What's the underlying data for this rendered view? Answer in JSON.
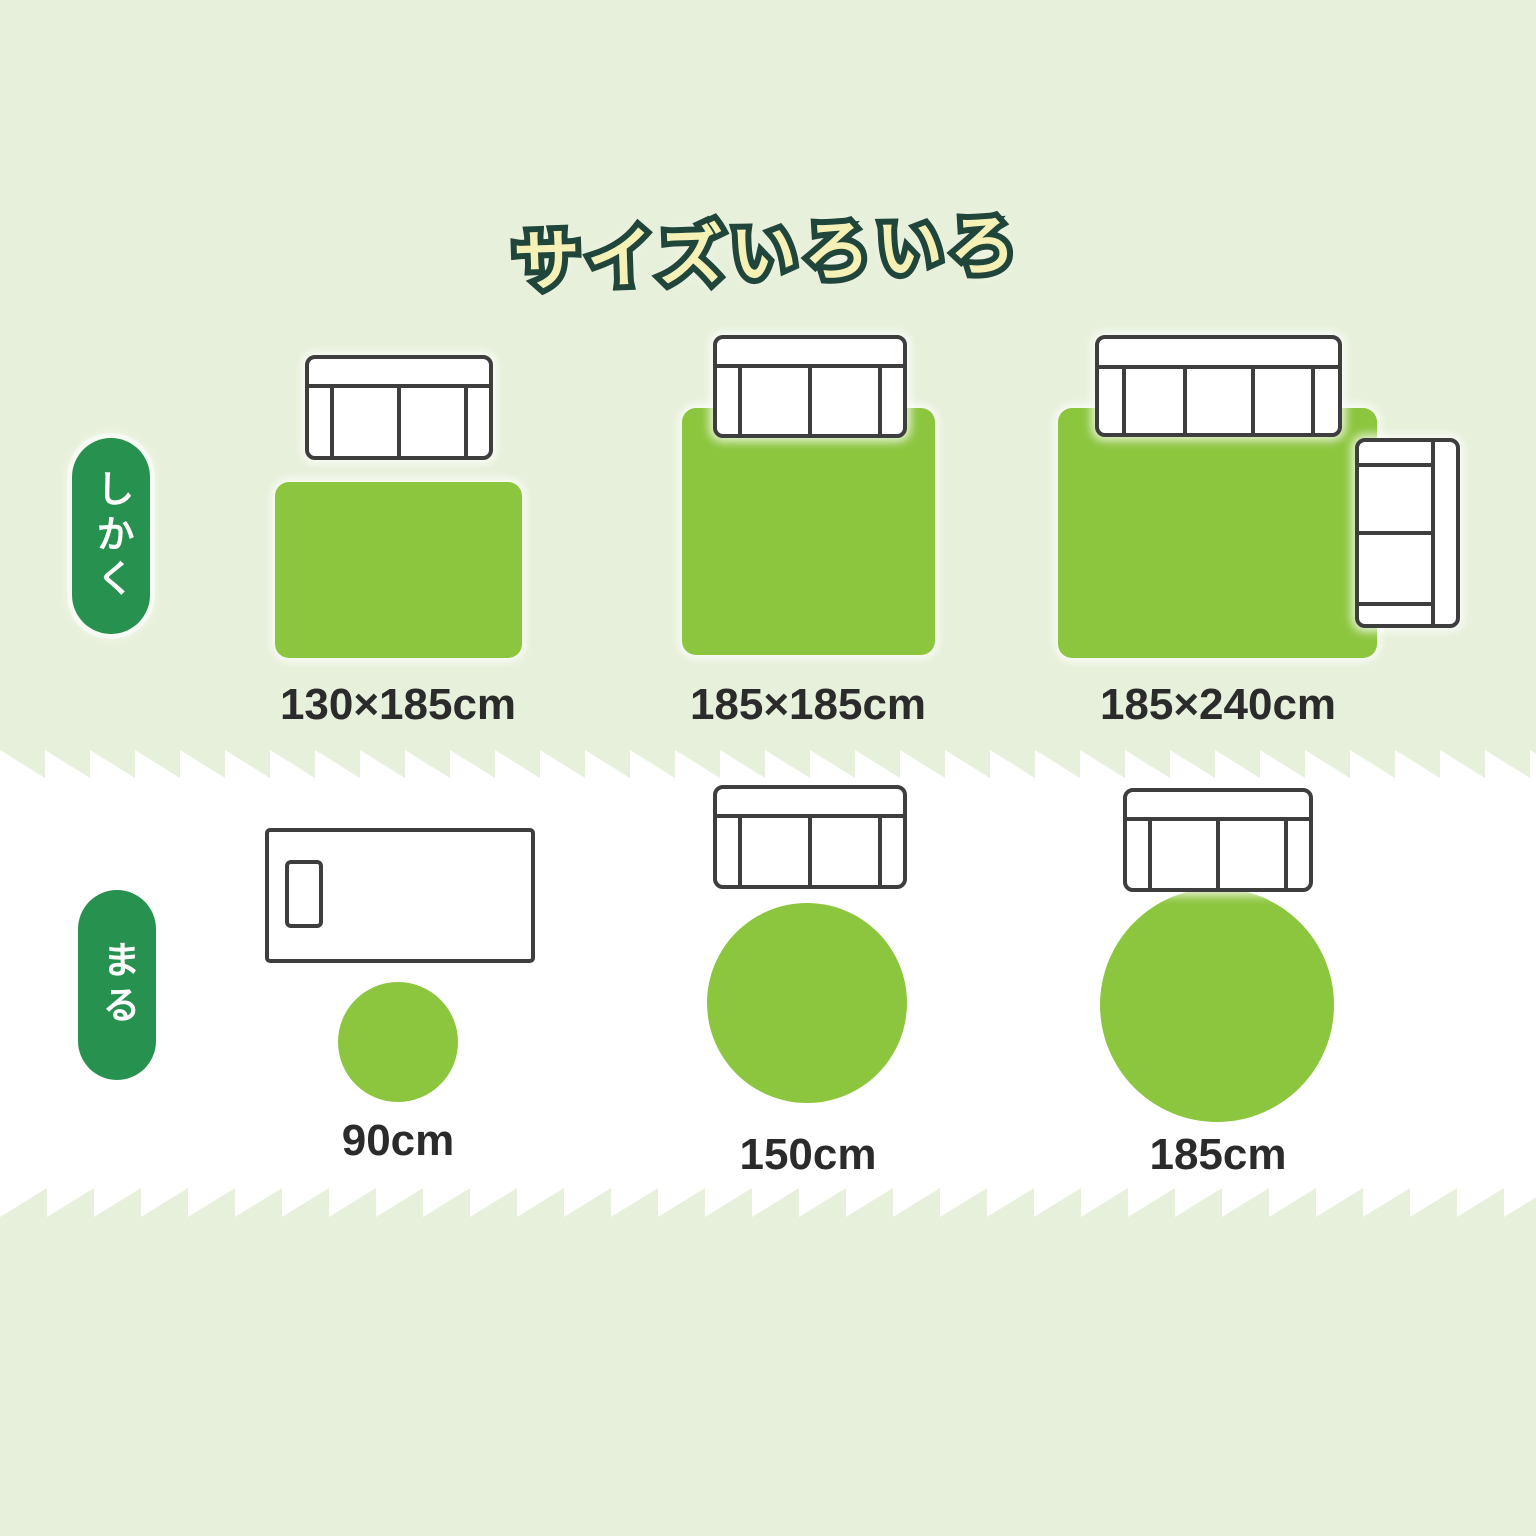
{
  "title": "サイズいろいろ",
  "sections": {
    "rect": {
      "badge": "しかく",
      "items": [
        {
          "shape": "rectangle",
          "label": "130×185cm",
          "furniture_icons": [
            "sofa-2seat-top-view-icon"
          ]
        },
        {
          "shape": "rectangle",
          "label": "185×185cm",
          "furniture_icons": [
            "sofa-2seat-top-view-icon"
          ]
        },
        {
          "shape": "rectangle",
          "label": "185×240cm",
          "furniture_icons": [
            "sofa-3seat-top-view-icon",
            "sofa-2seat-side-top-view-icon"
          ]
        }
      ]
    },
    "round": {
      "badge": "まる",
      "items": [
        {
          "shape": "circle",
          "label": "90cm",
          "furniture_icons": [
            "bed-top-view-icon"
          ]
        },
        {
          "shape": "circle",
          "label": "150cm",
          "furniture_icons": [
            "sofa-2seat-top-view-icon"
          ]
        },
        {
          "shape": "circle",
          "label": "185cm",
          "furniture_icons": [
            "sofa-2seat-top-view-icon"
          ]
        }
      ]
    }
  },
  "colors": {
    "section_background": "#e7f0da",
    "white_section": "#ffffff",
    "rug_green": "#8cc63f",
    "badge_green": "#27914f",
    "title_fill": "#f5f0b5",
    "title_outline": "#20453a",
    "furniture_outline": "#3e3e3e",
    "label_text": "#2b2b2b"
  }
}
